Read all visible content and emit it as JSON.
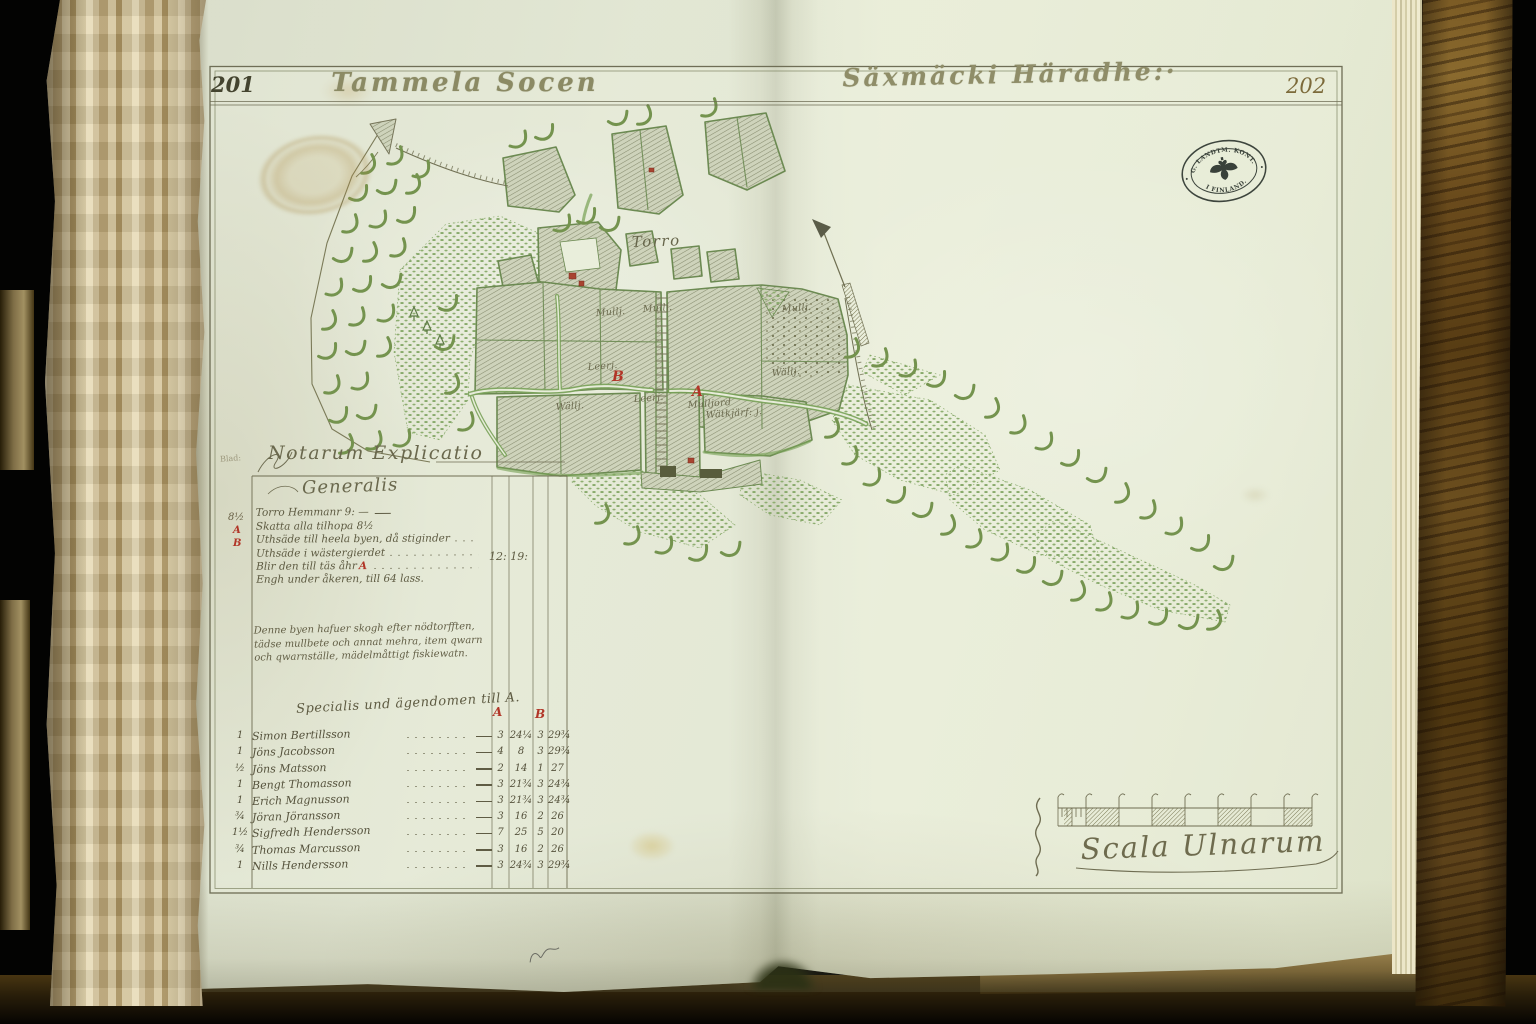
{
  "book": {
    "left_page_number": "201",
    "right_page_number": "202",
    "title_left": "Tammela Socen",
    "title_right": "Säxmäcki Häradhe:·",
    "stamp_right": {
      "top": "G. LANDTM. KONT.",
      "bottom": "I FINLAND."
    }
  },
  "map": {
    "village_label": "Torro",
    "marker_a": "A",
    "marker_b": "B",
    "parcel_labels": [
      "Mullj.",
      "Mullj.",
      "Leerj.",
      "Leerj.",
      "Mulljord",
      "Wällj.",
      "Mullj.",
      "Wällj.",
      "Wätkjärf: j."
    ]
  },
  "explicatio": {
    "fold_note": "Blad:",
    "heading": "Notarum Explicatio",
    "subheading": "Generalis",
    "margin_marks": {
      "skatt": "8½",
      "a": "A",
      "b": "B"
    },
    "lines": [
      {
        "text": "Torro Hemmanr 9: —"
      },
      {
        "text": "Skatta alla tilhopa 8½"
      },
      {
        "text": "Uthsäde till heela byen, då stiginder"
      },
      {
        "text": "Uthsäde i wästergierdet"
      },
      {
        "text": "Blir den till täs åhr",
        "red": "A"
      },
      {
        "text": "Engh under åkeren, till 64 lass."
      }
    ],
    "value": "12: 19:",
    "paragraph": [
      "Denne byen hafuer skogh efter nödtorfften,",
      "tädse mullbete och annat mehra, item qwarn",
      "och qwarnställe, mädelmåttigt fiskiewatn."
    ],
    "table": {
      "heading": "Specialis und ägendomen till A.",
      "col_a": "A",
      "col_b": "B",
      "rows": [
        {
          "m": "1",
          "name": "Simon Bertillsson",
          "a1": "3",
          "a2": "24¼",
          "b1": "3",
          "b2": "29¾"
        },
        {
          "m": "1",
          "name": "Jöns Jacobsson",
          "a1": "4",
          "a2": "8",
          "b1": "3",
          "b2": "29¾"
        },
        {
          "m": "½",
          "name": "Jöns Matsson",
          "a1": "2",
          "a2": "14",
          "b1": "1",
          "b2": "27"
        },
        {
          "m": "1",
          "name": "Bengt Thomasson",
          "a1": "3",
          "a2": "21¾",
          "b1": "3",
          "b2": "24¾"
        },
        {
          "m": "1",
          "name": "Erich Magnusson",
          "a1": "3",
          "a2": "21¾",
          "b1": "3",
          "b2": "24¾"
        },
        {
          "m": "¾",
          "name": "Jöran Jöransson",
          "a1": "3",
          "a2": "16",
          "b1": "2",
          "b2": "26"
        },
        {
          "m": "1½",
          "name": "Sigfredh Hendersson",
          "a1": "7",
          "a2": "25",
          "b1": "5",
          "b2": "20"
        },
        {
          "m": "¾",
          "name": "Thomas Marcusson",
          "a1": "3",
          "a2": "16",
          "b1": "2",
          "b2": "26"
        },
        {
          "m": "1",
          "name": "Nills Hendersson",
          "a1": "3",
          "a2": "24¾",
          "b1": "3",
          "b2": "29¾"
        }
      ]
    }
  },
  "scale": {
    "label": "Scala Ulnarum"
  },
  "colors": {
    "paper": "#e7ecd9",
    "ink": "#6b6950",
    "green": "#74934e",
    "red": "#b13527",
    "hatch": "#878c6f",
    "cover": "#6a4b1c"
  }
}
